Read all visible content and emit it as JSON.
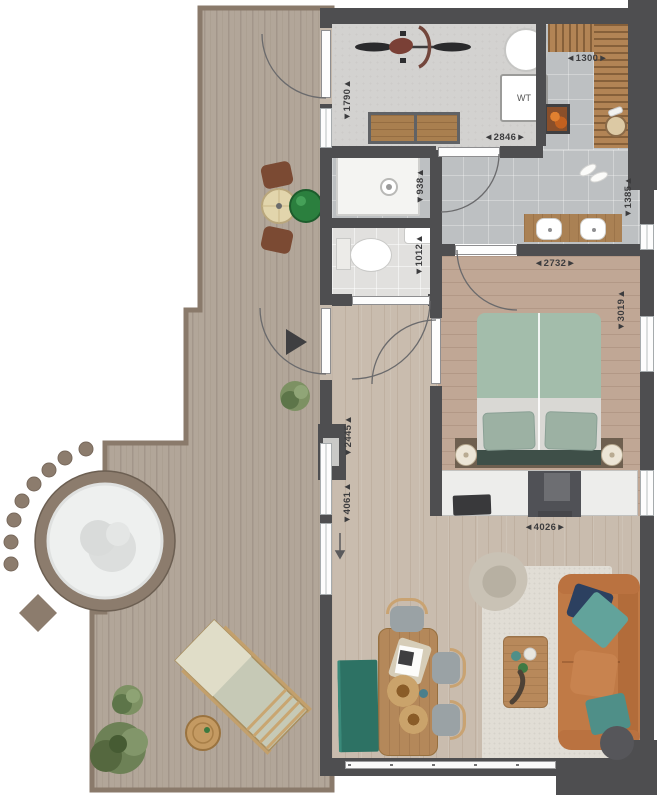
{
  "plan": {
    "type": "architectural-floor-plan",
    "labels": {
      "washer": "WT"
    },
    "dimensions": {
      "utility_height": "▼1790▲",
      "utility_width": "◄2846►",
      "sauna_width": "◄1300►",
      "shower_width": "▼938▲",
      "wc_width": "▼1012▲",
      "bath_height": "▼1385▲",
      "bedroom_width": "◄2732►",
      "bedroom_height": "▼3019▲",
      "living_width": "◄4026►",
      "hall_upper": "▼2445▲",
      "hall_lower": "▼4061▲"
    },
    "colors": {
      "wall": "#4e4e50",
      "deck_wood": "#b2a699",
      "deck_trim": "#8a7a6b",
      "floor_wood": "#c9bcae",
      "bedroom_wood": "#c0a795",
      "tile": "#bdc0c2",
      "sauna_wood": "#b28455",
      "sofa": "#c07a46",
      "bed_duvet": "#a3bdab",
      "accent_teal": "#2d7264",
      "grill_green": "#2b7f3e",
      "rug": "#e1ddd5",
      "hot_tub_rim": "#8c7c6d"
    }
  }
}
